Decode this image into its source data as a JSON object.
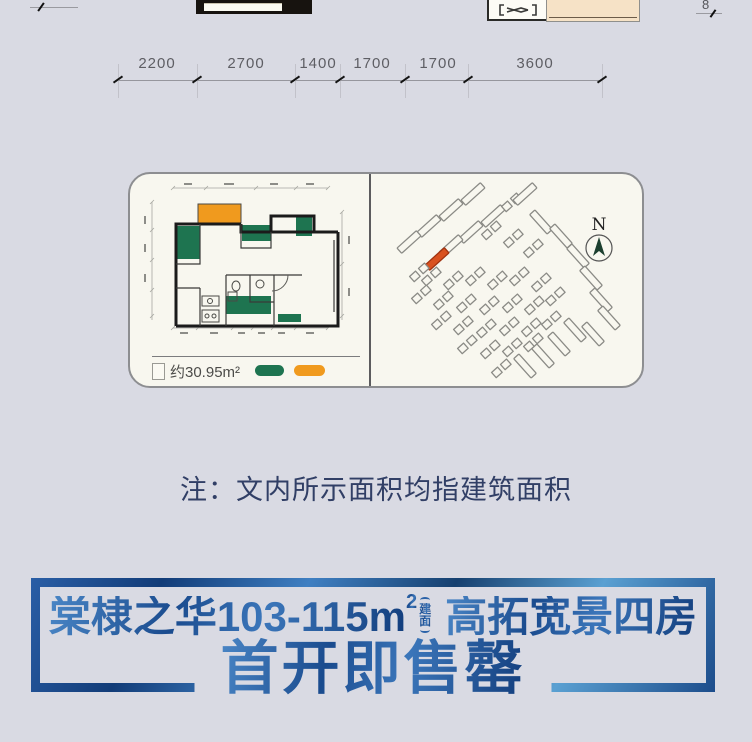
{
  "page": {
    "background": "#d9dae3"
  },
  "top_strip": {
    "partial_dim_label": "8"
  },
  "dimensions": {
    "labels": [
      "2200",
      "2700",
      "1400",
      "1700",
      "1700",
      "3600"
    ]
  },
  "card": {
    "floor_plan": {
      "area_label": "约30.95m²",
      "legend": {
        "green": "#1e7450",
        "orange": "#f09a1e"
      }
    },
    "site_plan": {
      "north_label": "N",
      "highlight_color": "#d9511f",
      "buildings": [
        [
          100,
          18,
          -42,
          "b"
        ],
        [
          78,
          34,
          -42,
          "b"
        ],
        [
          56,
          50,
          -42,
          "b"
        ],
        [
          36,
          66,
          -42,
          "b"
        ],
        [
          120,
          40,
          -42,
          "b"
        ],
        [
          98,
          56,
          -42,
          "b"
        ],
        [
          78,
          70,
          -42,
          "b"
        ],
        [
          64,
          83,
          -42,
          "h"
        ],
        [
          46,
          96,
          -42,
          "u"
        ],
        [
          138,
          26,
          -42,
          "u"
        ],
        [
          152,
          18,
          -42,
          "b"
        ],
        [
          168,
          46,
          48,
          "b"
        ],
        [
          188,
          60,
          48,
          "b"
        ],
        [
          205,
          80,
          48,
          "b"
        ],
        [
          218,
          102,
          48,
          "b"
        ],
        [
          228,
          124,
          48,
          "b"
        ],
        [
          236,
          142,
          48,
          "b"
        ],
        [
          220,
          158,
          48,
          "b"
        ],
        [
          152,
          190,
          48,
          "b"
        ],
        [
          170,
          180,
          48,
          "b"
        ],
        [
          186,
          168,
          48,
          "b"
        ],
        [
          202,
          154,
          48,
          "b"
        ],
        [
          118,
          54,
          -42,
          "u"
        ],
        [
          140,
          62,
          -42,
          "u"
        ],
        [
          160,
          72,
          -42,
          "u"
        ],
        [
          58,
          100,
          -42,
          "u"
        ],
        [
          80,
          104,
          -42,
          "u"
        ],
        [
          102,
          100,
          -42,
          "u"
        ],
        [
          124,
          104,
          -42,
          "u"
        ],
        [
          146,
          100,
          -42,
          "u"
        ],
        [
          168,
          106,
          -42,
          "u"
        ],
        [
          48,
          118,
          -42,
          "u"
        ],
        [
          70,
          124,
          -42,
          "u"
        ],
        [
          93,
          127,
          -42,
          "u"
        ],
        [
          116,
          129,
          -42,
          "u"
        ],
        [
          139,
          127,
          -42,
          "u"
        ],
        [
          161,
          129,
          -42,
          "u"
        ],
        [
          182,
          120,
          -42,
          "u"
        ],
        [
          68,
          144,
          -42,
          "u"
        ],
        [
          90,
          149,
          -42,
          "u"
        ],
        [
          113,
          152,
          -42,
          "u"
        ],
        [
          136,
          150,
          -42,
          "u"
        ],
        [
          158,
          151,
          -42,
          "u"
        ],
        [
          178,
          144,
          -42,
          "u"
        ],
        [
          94,
          168,
          -42,
          "u"
        ],
        [
          117,
          173,
          -42,
          "u"
        ],
        [
          139,
          171,
          -42,
          "u"
        ],
        [
          160,
          166,
          -42,
          "u"
        ],
        [
          128,
          192,
          -42,
          "u"
        ]
      ]
    }
  },
  "note": {
    "text": "注：文内所示面积均指建筑面积"
  },
  "banner": {
    "line1_prefix": "棠棣之华103-115m",
    "line1_sup": "2",
    "jm_top": "建",
    "jm_bottom": "面",
    "line1_suffix": "高拓宽景四房",
    "line2": "首开即售罄",
    "accent": "#2a62a8"
  }
}
